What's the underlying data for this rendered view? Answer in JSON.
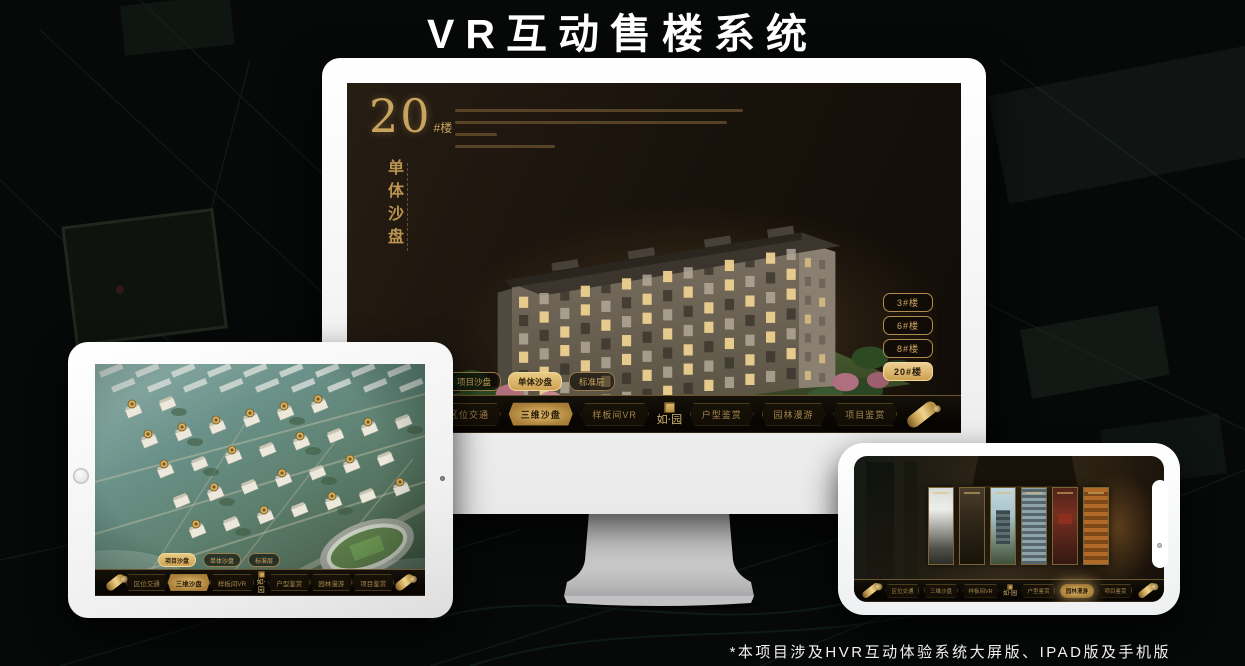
{
  "page": {
    "title": "VR互动售楼系统",
    "footnote": "*本项目涉及HVR互动体验系统大屏版、IPAD版及手机版"
  },
  "colors": {
    "gold": "#c9a45f",
    "gold_bright": "#e7c87e",
    "gold_dim": "#8d7441",
    "screen_bg": "#1b130c",
    "nav_bg": "#0c0905",
    "active_button_bg": "#d9b266",
    "active_text": "#241a0c",
    "title_text": "#ffffff"
  },
  "logo_text": "如·园",
  "nav_items": [
    {
      "key": "location-traffic",
      "label": "区位交通"
    },
    {
      "key": "sandbox-3d",
      "label": "三维沙盘"
    },
    {
      "key": "model-room-vr",
      "label": "样板间VR"
    },
    {
      "key": "unit-appreciation",
      "label": "户型鉴赏"
    },
    {
      "key": "garden-tour",
      "label": "园林漫游"
    },
    {
      "key": "project-appreciation",
      "label": "项目鉴赏"
    }
  ],
  "sub_tabs": [
    {
      "key": "project-sandbox",
      "label": "项目沙盘"
    },
    {
      "key": "single-sandbox",
      "label": "单体沙盘"
    },
    {
      "key": "standard-floor",
      "label": "标准层"
    }
  ],
  "monitor": {
    "headline_number": "20",
    "headline_unit": "#楼",
    "headline_subtitle": "单体沙盘",
    "active_nav": "sandbox-3d",
    "active_sub_tab": "single-sandbox",
    "floor_buttons": [
      {
        "label": "3#楼",
        "active": false
      },
      {
        "label": "6#楼",
        "active": false
      },
      {
        "label": "8#楼",
        "active": false
      },
      {
        "label": "20#楼",
        "active": true
      }
    ]
  },
  "tablet": {
    "active_nav": "sandbox-3d",
    "active_sub_tab": "project-sandbox"
  },
  "phone": {
    "active_nav": "garden-tour",
    "gallery_panels": [
      "interior-light",
      "interior-dark",
      "exterior-day",
      "facade-grid",
      "signage-red",
      "interior-warm"
    ]
  }
}
